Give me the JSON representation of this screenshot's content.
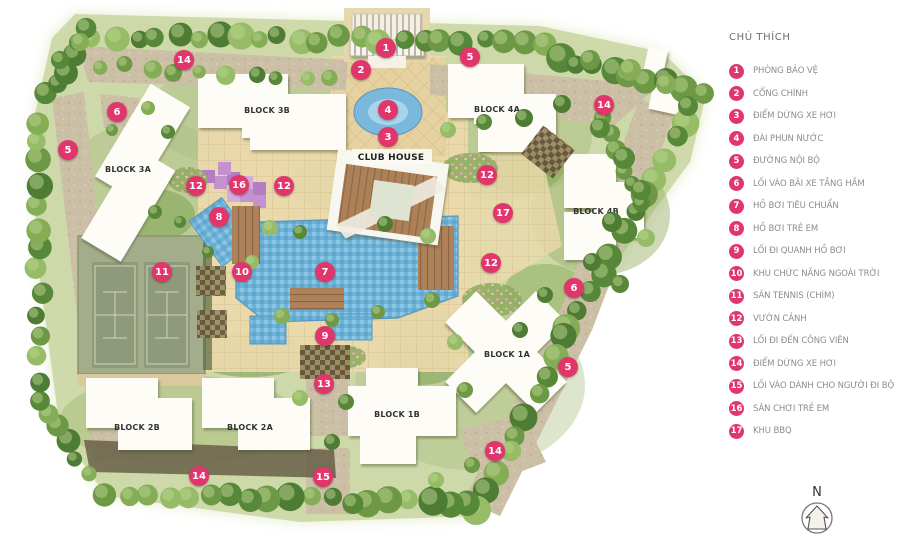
{
  "legend": {
    "title": "CHÚ THÍCH",
    "items": [
      {
        "num": "1",
        "label": "PHÒNG BẢO VỆ"
      },
      {
        "num": "2",
        "label": "CỔNG CHÍNH"
      },
      {
        "num": "3",
        "label": "ĐIỂM DỪNG XE HƠI"
      },
      {
        "num": "4",
        "label": "ĐÀI PHUN NƯỚC"
      },
      {
        "num": "5",
        "label": "ĐƯỜNG NỘI BỘ"
      },
      {
        "num": "6",
        "label": "LỐI VÀO BÃI XE TẦNG HẦM"
      },
      {
        "num": "7",
        "label": "HỒ BƠI TIÊU CHUẨN"
      },
      {
        "num": "8",
        "label": "HỒ BƠI TRẺ EM"
      },
      {
        "num": "9",
        "label": "LỐI ĐI QUANH HỒ BƠI"
      },
      {
        "num": "10",
        "label": "KHU CHỨC NĂNG NGOÀI TRỜI"
      },
      {
        "num": "11",
        "label": "SÂN TENNIS (CHÌM)"
      },
      {
        "num": "12",
        "label": "VƯỜN CẢNH"
      },
      {
        "num": "13",
        "label": "LỐI ĐI ĐẾN CÔNG VIÊN"
      },
      {
        "num": "14",
        "label": "ĐIỂM DỪNG XE HƠI"
      },
      {
        "num": "15",
        "label": "LỐI VÀO DÀNH CHO NGƯỜI ĐI BỘ"
      },
      {
        "num": "16",
        "label": "SÂN CHƠI TRẺ EM"
      },
      {
        "num": "17",
        "label": "KHU BBQ"
      }
    ]
  },
  "map": {
    "club_house_label": "CLUB HOUSE",
    "blocks": [
      {
        "label": "BLOCK 3A"
      },
      {
        "label": "BLOCK 3B"
      },
      {
        "label": "BLOCK 4A"
      },
      {
        "label": "BLOCK 4B"
      },
      {
        "label": "BLOCK 1A"
      },
      {
        "label": "BLOCK 1B"
      },
      {
        "label": "BLOCK 2A"
      },
      {
        "label": "BLOCK 2B"
      }
    ],
    "markers": [
      {
        "num": "1",
        "x": 386,
        "y": 48
      },
      {
        "num": "2",
        "x": 361,
        "y": 70
      },
      {
        "num": "3",
        "x": 388,
        "y": 137
      },
      {
        "num": "4",
        "x": 388,
        "y": 110
      },
      {
        "num": "5",
        "x": 470,
        "y": 57
      },
      {
        "num": "5",
        "x": 68,
        "y": 150
      },
      {
        "num": "5",
        "x": 568,
        "y": 367
      },
      {
        "num": "6",
        "x": 117,
        "y": 112
      },
      {
        "num": "6",
        "x": 574,
        "y": 288
      },
      {
        "num": "7",
        "x": 325,
        "y": 272
      },
      {
        "num": "8",
        "x": 219,
        "y": 217
      },
      {
        "num": "9",
        "x": 325,
        "y": 336
      },
      {
        "num": "10",
        "x": 242,
        "y": 272
      },
      {
        "num": "11",
        "x": 162,
        "y": 272
      },
      {
        "num": "12",
        "x": 196,
        "y": 186
      },
      {
        "num": "12",
        "x": 284,
        "y": 186
      },
      {
        "num": "12",
        "x": 487,
        "y": 175
      },
      {
        "num": "12",
        "x": 491,
        "y": 263
      },
      {
        "num": "13",
        "x": 324,
        "y": 384
      },
      {
        "num": "14",
        "x": 184,
        "y": 60
      },
      {
        "num": "14",
        "x": 604,
        "y": 105
      },
      {
        "num": "14",
        "x": 199,
        "y": 476
      },
      {
        "num": "14",
        "x": 495,
        "y": 451
      },
      {
        "num": "15",
        "x": 323,
        "y": 477
      },
      {
        "num": "16",
        "x": 239,
        "y": 185
      },
      {
        "num": "17",
        "x": 503,
        "y": 213
      }
    ]
  },
  "compass": {
    "label": "N"
  },
  "colors": {
    "accent_pink": "#e0366b",
    "legend_text": "#8c8c8c",
    "block_text": "#333333",
    "pool_blue": "#6fb2d8",
    "tennis_green": "#8e9a7a",
    "deck_brown": "#ad8159",
    "playground_purple": "#c493cf"
  }
}
